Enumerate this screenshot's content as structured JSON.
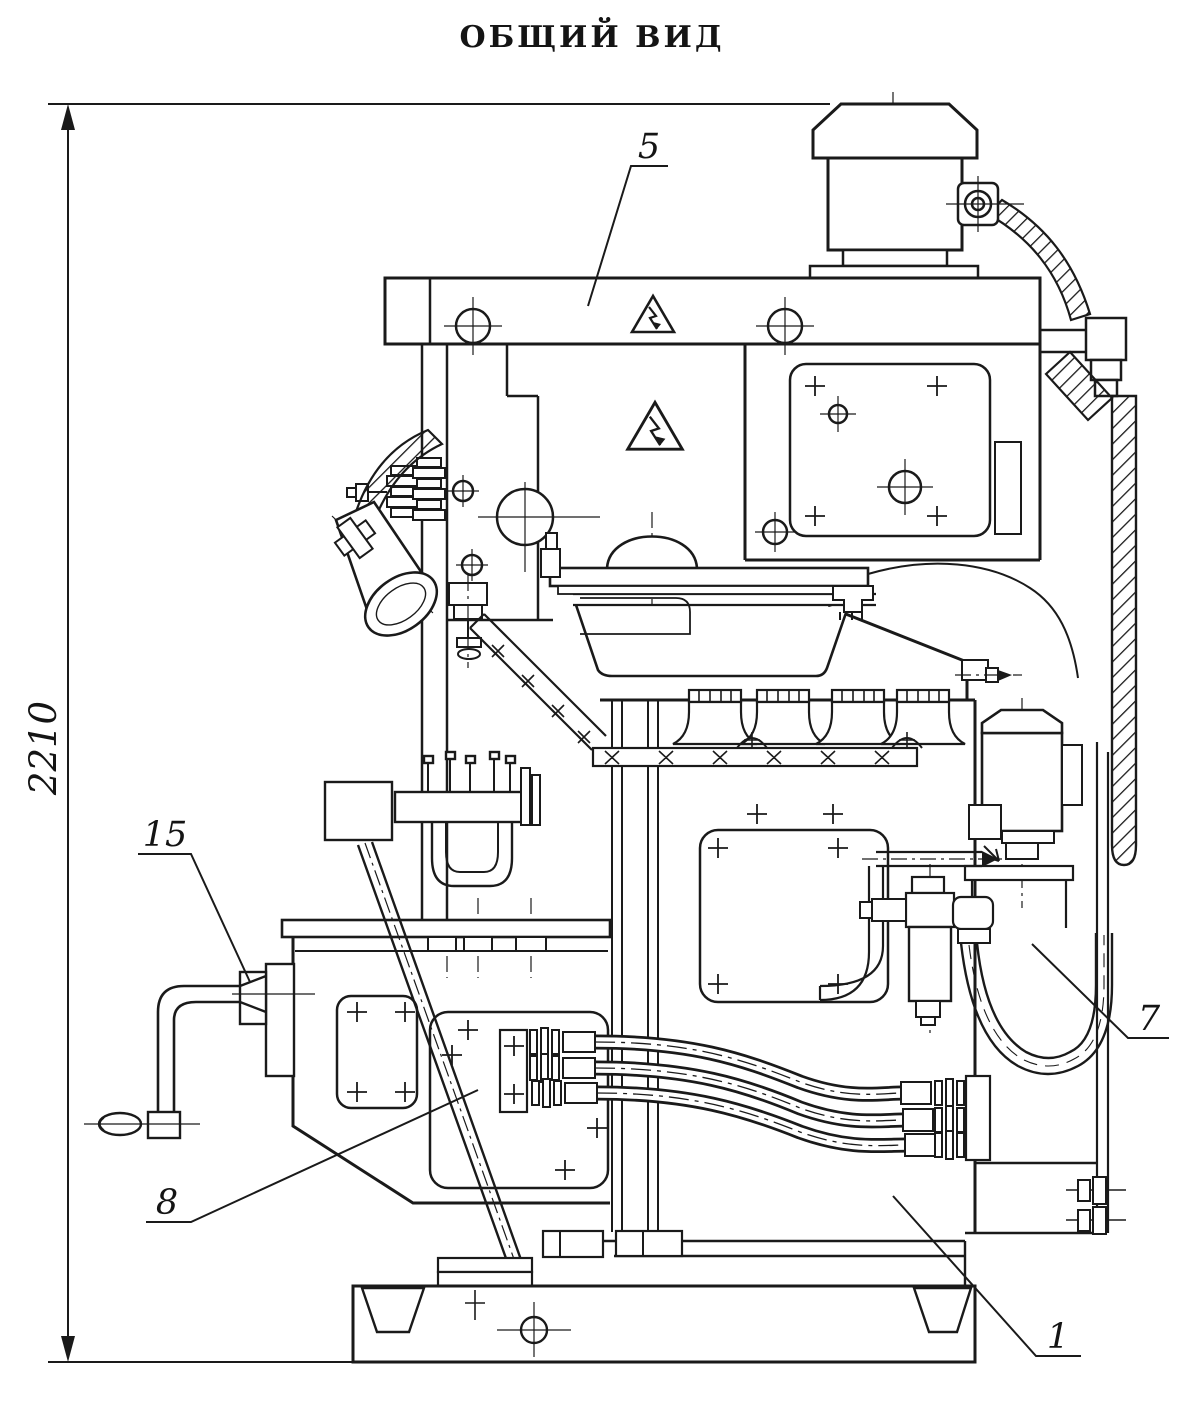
{
  "page": {
    "title": "ОБЩИЙ ВИД",
    "dimension": {
      "value": "2210"
    },
    "callouts": [
      {
        "number": "5"
      },
      {
        "number": "15"
      },
      {
        "number": "8"
      },
      {
        "number": "7"
      },
      {
        "number": "1"
      }
    ],
    "icons": {
      "warning": "high-voltage-warning-triangle"
    },
    "colors": {
      "ink": "#1a1a1a",
      "paper": "#ffffff"
    }
  }
}
